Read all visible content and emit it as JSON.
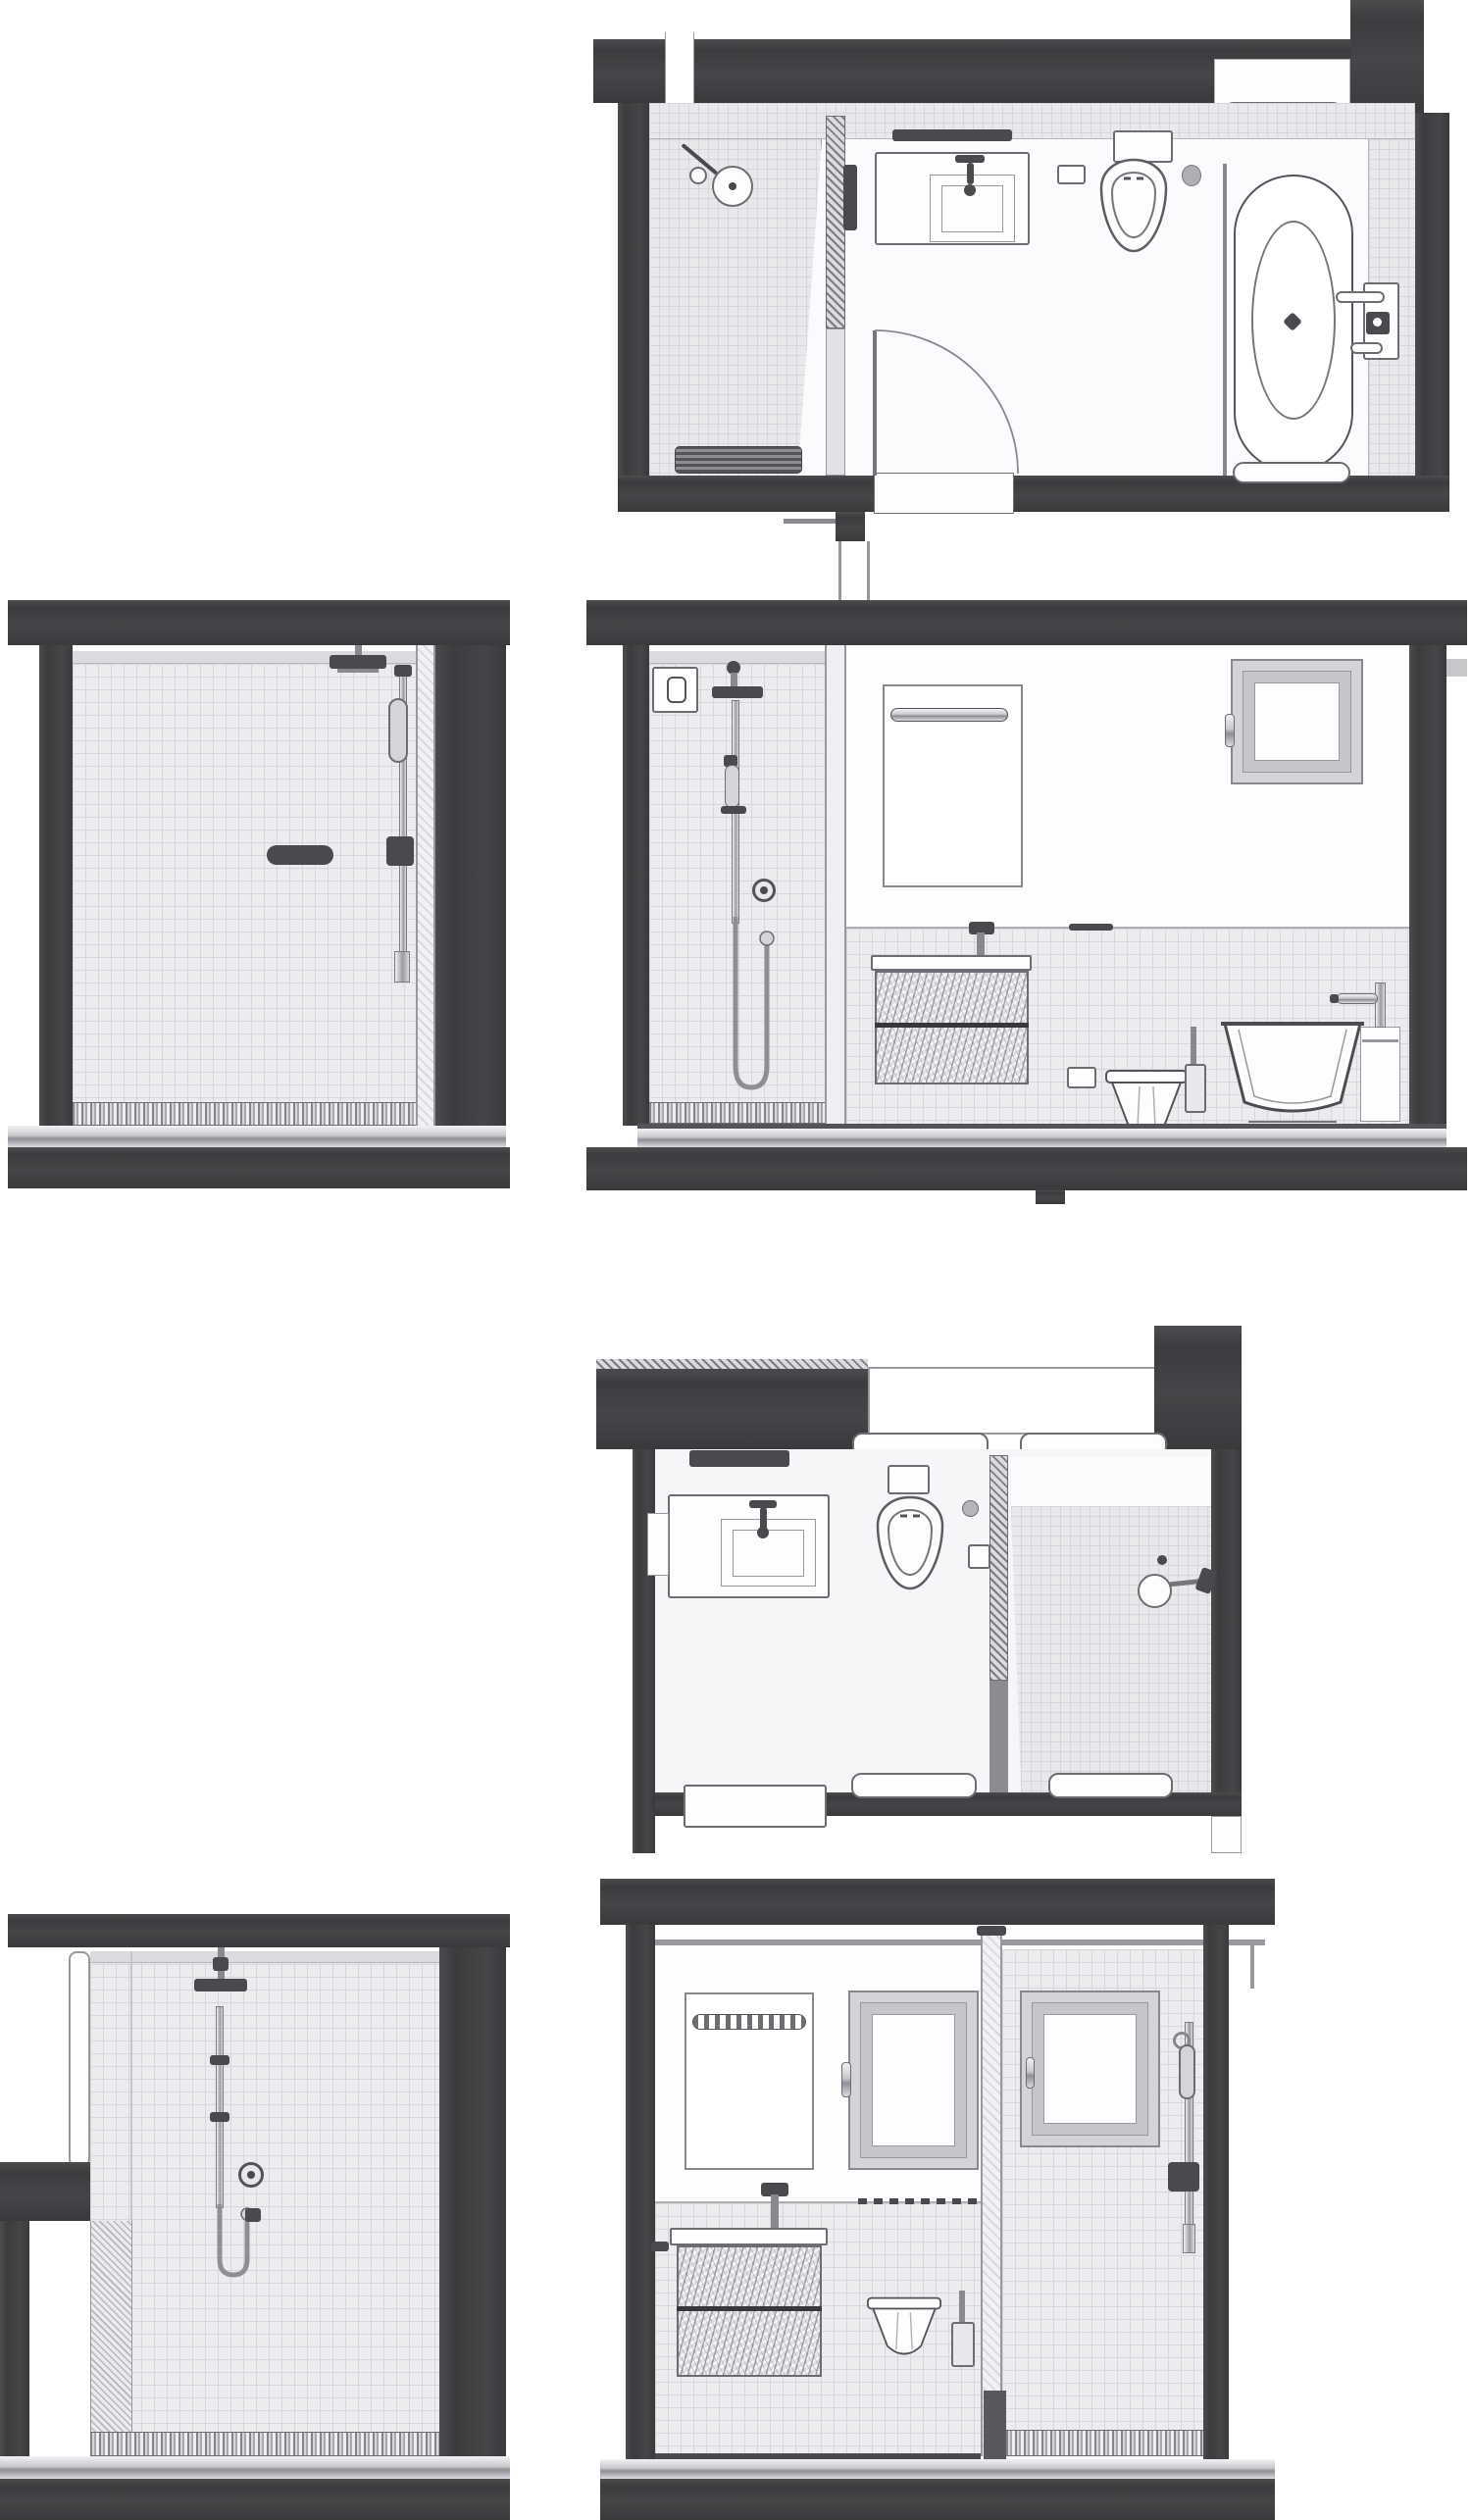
{
  "document": {
    "type": "architectural-drawing",
    "subject": "bathroom floor plans and interior elevations",
    "panel_count": 6,
    "visible_text": ""
  },
  "colors": {
    "wall": "#424144",
    "wall2": "#4b494e",
    "line": "#6e6c72",
    "tile": "#edebee",
    "tl": "#d8d6da",
    "fix": "#fdfdfe",
    "metal": "#c9c8cd",
    "bg": "#ffffff"
  },
  "panels": [
    {
      "id": "floor-plan-top",
      "kind": "floor-plan",
      "fixtures": [
        "walk-in-shower",
        "shower-head",
        "glass-partition",
        "vanity-counter",
        "basin-sink",
        "wall-hung-toilet",
        "cistern",
        "flush-plate",
        "freestanding-bathtub",
        "tub-faucet-set",
        "towel-rail-niche",
        "door-swing",
        "door-threshold",
        "supply-pipes"
      ]
    },
    {
      "id": "elevation-shower-left-1",
      "kind": "elevation",
      "fixtures": [
        "tiled-wall",
        "rain-shower-head",
        "shower-slide-bar",
        "hand-shower",
        "towel-bar",
        "glass-screen-edge",
        "shower-tray"
      ]
    },
    {
      "id": "elevation-bathroom-1",
      "kind": "elevation",
      "fixtures": [
        "tiled-shower-wall",
        "recessed-control-niche",
        "rain-shower-head",
        "shower-slide-bar",
        "hand-shower-hose",
        "mixer-knob",
        "mirror",
        "mirror-towel-bar",
        "basin-faucet",
        "vanity-two-drawers",
        "flush-plate",
        "wall-hung-toilet",
        "toilet-roll",
        "toilet-brush",
        "bathtub",
        "tub-faucet",
        "casement-window",
        "tiled-wainscot"
      ]
    },
    {
      "id": "floor-plan-bottom",
      "kind": "floor-plan",
      "fixtures": [
        "vanity-counter",
        "basin-sink",
        "wall-hung-toilet",
        "cistern",
        "flush-button",
        "wall-niche-box",
        "glass-partition",
        "walk-in-shower",
        "shower-head",
        "window-bay",
        "window-sills",
        "door-threshold",
        "entry-mats"
      ]
    },
    {
      "id": "elevation-shower-left-2",
      "kind": "elevation",
      "fixtures": [
        "tiled-wall",
        "rain-shower-head",
        "shower-slide-bar",
        "hand-shower-hose",
        "mixer-knob",
        "shut-off-valve",
        "door-jamb",
        "half-wall",
        "shower-floor"
      ]
    },
    {
      "id": "elevation-bathroom-2",
      "kind": "elevation",
      "fixtures": [
        "mirror-with-light-bar",
        "casement-window",
        "shower-casement-window",
        "glass-partition",
        "shower-slide-bar",
        "hand-shower",
        "basin-faucet",
        "vanity-two-drawers",
        "wall-hung-toilet",
        "toilet-brush",
        "tiled-wainscot",
        "shower-curb",
        "shower-floor"
      ]
    }
  ]
}
